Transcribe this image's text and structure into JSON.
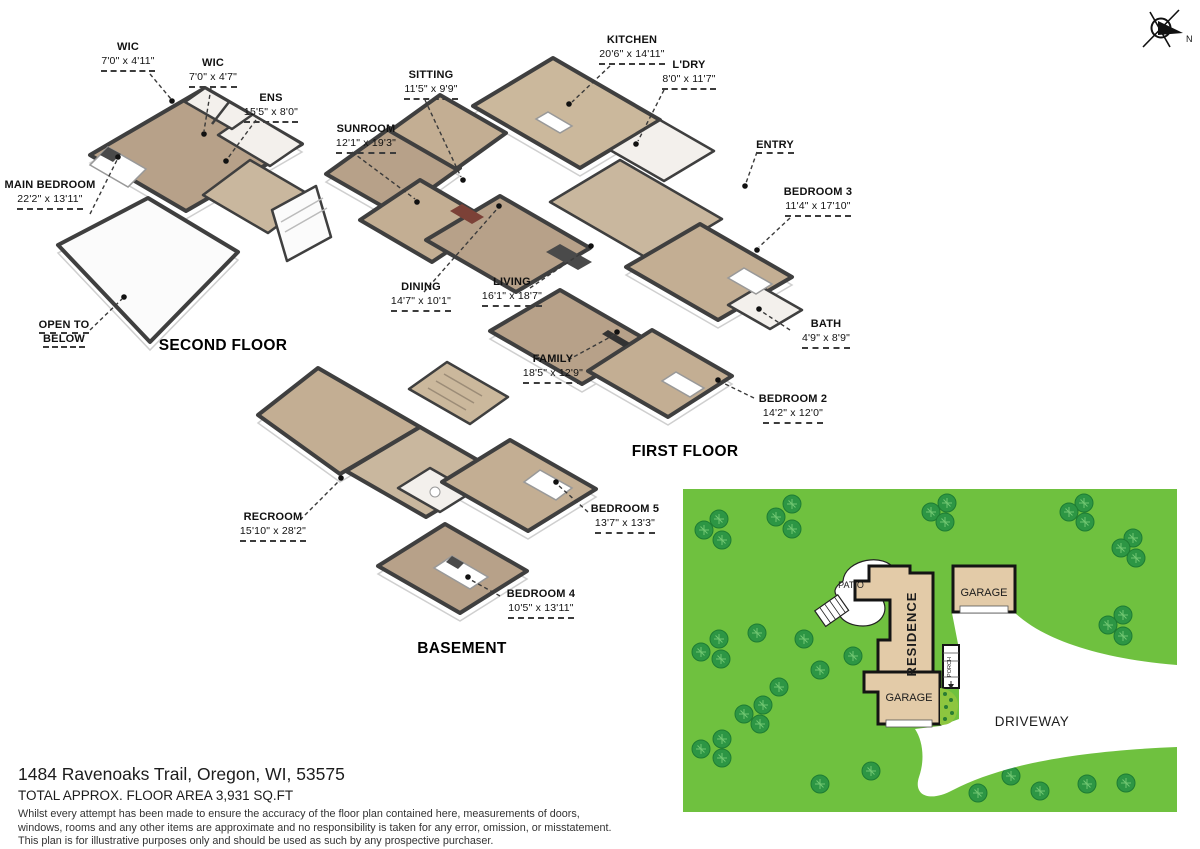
{
  "compass": {
    "label": "N"
  },
  "floors": [
    {
      "id": "second-floor",
      "title": "SECOND FLOOR"
    },
    {
      "id": "first-floor",
      "title": "FIRST FLOOR"
    },
    {
      "id": "basement",
      "title": "BASEMENT"
    }
  ],
  "room_labels": [
    {
      "id": "wic-1",
      "name": "WIC",
      "dims": "7'0\" x 4'11\"",
      "x": 128,
      "y": 40,
      "w": 104,
      "leader": [
        [
          150,
          74
        ],
        [
          171,
          99
        ]
      ],
      "dot": [
        172,
        101
      ]
    },
    {
      "id": "wic-2",
      "name": "WIC",
      "dims": "7'0\" x 4'7\"",
      "x": 213,
      "y": 56,
      "w": 100,
      "leader": [
        [
          211,
          88
        ],
        [
          204,
          131
        ]
      ],
      "dot": [
        204,
        134
      ]
    },
    {
      "id": "ens",
      "name": "ENS",
      "dims": "15'5\" x 8'0\"",
      "x": 271,
      "y": 91,
      "w": 100,
      "leader": [
        [
          256,
          120
        ],
        [
          228,
          158
        ]
      ],
      "dot": [
        226,
        161
      ]
    },
    {
      "id": "main-bedroom",
      "name": "MAIN BEDROOM",
      "dims": "22'2\" x 13'11\"",
      "x": 50,
      "y": 178,
      "w": 96,
      "leader": [
        [
          90,
          214
        ],
        [
          117,
          160
        ]
      ],
      "dot": [
        118,
        157
      ]
    },
    {
      "id": "open-to-below",
      "name": "OPEN TO BELOW",
      "dims": "",
      "x": 64,
      "y": 318,
      "w": 86,
      "leader": [
        [
          90,
          330
        ],
        [
          122,
          299
        ]
      ],
      "dot": [
        124,
        297
      ]
    },
    {
      "id": "sitting",
      "name": "SITTING",
      "dims": "11'5\" x 9'9\"",
      "x": 431,
      "y": 68,
      "w": 100,
      "leader": [
        [
          425,
          100
        ],
        [
          461,
          177
        ]
      ],
      "dot": [
        463,
        180
      ]
    },
    {
      "id": "kitchen",
      "name": "KITCHEN",
      "dims": "20'6\" x 14'11\"",
      "x": 632,
      "y": 33,
      "w": 110,
      "leader": [
        [
          610,
          66
        ],
        [
          572,
          102
        ]
      ],
      "dot": [
        569,
        104
      ]
    },
    {
      "id": "ldry",
      "name": "L'DRY",
      "dims": "8'0\" x 11'7\"",
      "x": 689,
      "y": 58,
      "w": 96,
      "leader": [
        [
          664,
          90
        ],
        [
          638,
          141
        ]
      ],
      "dot": [
        636,
        144
      ]
    },
    {
      "id": "sunroom",
      "name": "SUNROOM",
      "dims": "12'1\" x 19'3\"",
      "x": 366,
      "y": 122,
      "w": 106,
      "leader": [
        [
          352,
          152
        ],
        [
          415,
          199
        ]
      ],
      "dot": [
        417,
        202
      ]
    },
    {
      "id": "entry",
      "name": "ENTRY",
      "dims": "",
      "x": 775,
      "y": 138,
      "w": 64,
      "leader": [
        [
          757,
          152
        ],
        [
          746,
          183
        ]
      ],
      "dot": [
        745,
        186
      ]
    },
    {
      "id": "bedroom-3",
      "name": "BEDROOM 3",
      "dims": "11'4\" x 17'10\"",
      "x": 818,
      "y": 185,
      "w": 116,
      "leader": [
        [
          790,
          218
        ],
        [
          759,
          247
        ]
      ],
      "dot": [
        757,
        250
      ]
    },
    {
      "id": "dining",
      "name": "DINING",
      "dims": "14'7\" x 10'1\"",
      "x": 421,
      "y": 280,
      "w": 104,
      "leader": [
        [
          424,
          292
        ],
        [
          497,
          209
        ]
      ],
      "dot": [
        499,
        206
      ]
    },
    {
      "id": "living",
      "name": "LIVING",
      "dims": "16'1\" x 18'7\"",
      "x": 512,
      "y": 275,
      "w": 104,
      "leader": [
        [
          530,
          288
        ],
        [
          589,
          248
        ]
      ],
      "dot": [
        591,
        246
      ]
    },
    {
      "id": "bath",
      "name": "BATH",
      "dims": "4'9\" x 8'9\"",
      "x": 826,
      "y": 317,
      "w": 100,
      "leader": [
        [
          790,
          330
        ],
        [
          761,
          311
        ]
      ],
      "dot": [
        759,
        309
      ]
    },
    {
      "id": "bedroom-2",
      "name": "BEDROOM 2",
      "dims": "14'2\" x 12'0\"",
      "x": 793,
      "y": 392,
      "w": 116,
      "leader": [
        [
          754,
          398
        ],
        [
          721,
          382
        ]
      ],
      "dot": [
        718,
        380
      ]
    },
    {
      "id": "family",
      "name": "FAMILY",
      "dims": "18'5\" x 12'9\"",
      "x": 553,
      "y": 352,
      "w": 104,
      "leader": [
        [
          568,
          360
        ],
        [
          614,
          335
        ]
      ],
      "dot": [
        617,
        332
      ]
    },
    {
      "id": "recroom",
      "name": "RECROOM",
      "dims": "15'10\" x 28'2\"",
      "x": 273,
      "y": 510,
      "w": 110,
      "leader": [
        [
          300,
          520
        ],
        [
          339,
          481
        ]
      ],
      "dot": [
        341,
        478
      ]
    },
    {
      "id": "bedroom-5",
      "name": "BEDROOM 5",
      "dims": "13'7\" x 13'3\"",
      "x": 625,
      "y": 502,
      "w": 112,
      "leader": [
        [
          588,
          512
        ],
        [
          558,
          485
        ]
      ],
      "dot": [
        556,
        482
      ]
    },
    {
      "id": "bedroom-4",
      "name": "BEDROOM 4",
      "dims": "10'5\" x 13'11\"",
      "x": 541,
      "y": 587,
      "w": 112,
      "leader": [
        [
          500,
          596
        ],
        [
          471,
          580
        ]
      ],
      "dot": [
        468,
        577
      ]
    }
  ],
  "site_plan": {
    "labels": {
      "patio": "PATIO",
      "residence": "RESIDENCE",
      "garage_upper": "GARAGE",
      "garage_lower": "GARAGE",
      "porch": "PORCH",
      "driveway": "DRIVEWAY"
    },
    "colors": {
      "lawn": "#6fc13f",
      "tree": "#2d9644",
      "building": "#e3cba8",
      "driveway": "#ffffff",
      "garden": "#8dc63f"
    },
    "trees": [
      [
        36,
        30
      ],
      [
        21,
        41
      ],
      [
        39,
        51
      ],
      [
        93,
        28
      ],
      [
        109,
        15
      ],
      [
        109,
        40
      ],
      [
        248,
        23
      ],
      [
        264,
        14
      ],
      [
        262,
        33
      ],
      [
        401,
        14
      ],
      [
        386,
        23
      ],
      [
        402,
        33
      ],
      [
        450,
        49
      ],
      [
        438,
        59
      ],
      [
        453,
        69
      ],
      [
        440,
        126
      ],
      [
        425,
        136
      ],
      [
        440,
        147
      ],
      [
        456,
        198
      ],
      [
        438,
        209
      ],
      [
        456,
        219
      ],
      [
        74,
        144
      ],
      [
        36,
        150
      ],
      [
        18,
        163
      ],
      [
        38,
        170
      ],
      [
        121,
        150
      ],
      [
        170,
        167
      ],
      [
        137,
        181
      ],
      [
        96,
        198
      ],
      [
        80,
        216
      ],
      [
        61,
        225
      ],
      [
        77,
        235
      ],
      [
        39,
        250
      ],
      [
        18,
        260
      ],
      [
        39,
        269
      ],
      [
        188,
        282
      ],
      [
        248,
        286
      ],
      [
        295,
        304
      ],
      [
        328,
        287
      ],
      [
        357,
        302
      ],
      [
        404,
        295
      ],
      [
        443,
        294
      ],
      [
        137,
        295
      ]
    ]
  },
  "footer": {
    "address": "1484 Ravenoaks Trail, Oregon, WI, 53575",
    "area": "TOTAL APPROX. FLOOR AREA 3,931 SQ.FT",
    "disclaimer_lines": [
      "Whilst every attempt has been made to ensure the accuracy of the floor plan contained here, measurements of doors,",
      "windows, rooms and any other items are approximate and no responsibility is taken for any error, omission, or misstatement.",
      "This plan is for illustrative purposes only and should be used as such by any prospective purchaser."
    ]
  }
}
